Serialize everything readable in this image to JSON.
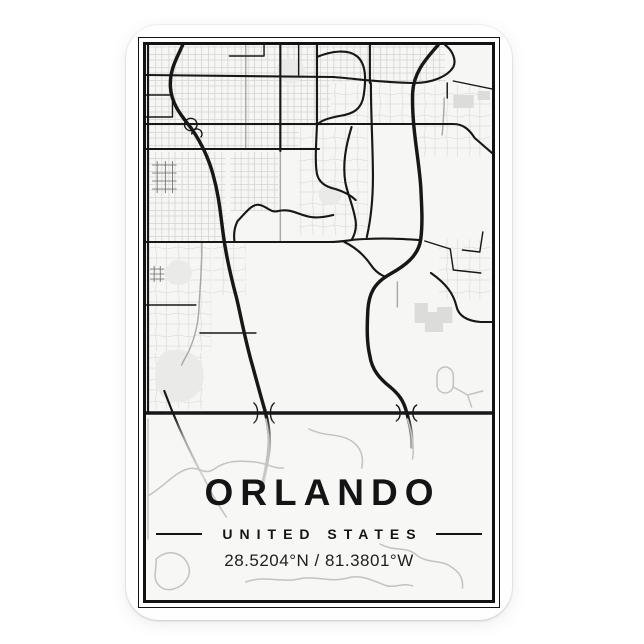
{
  "poster": {
    "title": "ORLANDO",
    "subtitle": "UNITED STATES",
    "coordinates": "28.5204°N / 81.3801°W"
  },
  "colors": {
    "page_bg": "#ffffff",
    "card_bg": "#fefefe",
    "frame": "#121212",
    "map_bg": "#f6f6f4",
    "road_major": "#171717",
    "road_medium": "#a8a8a8",
    "road_minor": "#d4d4d2",
    "road_minor_light": "#dfdedc",
    "road_faded": "#c3c3c1",
    "block_fill": "#eaeae8",
    "structure_fill": "#dcdcda",
    "text": "#141414"
  },
  "map": {
    "highways": [
      "M 186,46 C 181,58 173,70 174,88 C 175,106 186,118 195,130 C 203,142 211,157 216,176 C 222,198 223,214 226,236 C 229,259 234,280 239,299 C 243,316 248,344 255,368 C 259,383 263,398 267,412 C 270,424 272,436 271,448 C 270,462 267,472 265,484",
      "M 437,46 C 427,58 413,72 412,94 C 411,128 418,158 420,188 C 421,209 422,224 420,240 C 418,257 404,267 390,275 C 374,284 369,295 368,311 C 367,330 367,344 370,357 C 372,371 380,380 390,388 C 398,395 403,401 406,413 C 409,424 412,436 411,448",
      "M 150,414 L 490,414"
    ],
    "majors": [
      "M 150,76 L 334,78 C 358,80 388,84 414,84 C 430,84 446,78 452,68 C 455,62 452,52 444,46",
      "M 150,125 L 452,125 C 462,125 468,131 473,139 L 490,154",
      "M 150,150 L 320,150",
      "M 150,243 L 330,243 C 346,243 352,240 366,240 C 386,239 402,240 419,241",
      "M 282,46 L 282,152",
      "M 318,46 L 318,126",
      "M 318,58 C 332,52 348,50 357,57 C 367,65 366,82 364,96 C 362,110 354,115 340,117 C 329,119 321,122 318,126",
      "M 370,46 L 370,84",
      "M 371,84 C 371,118 373,148 373,178 C 373,200 371,220 367,238",
      "M 152,46 L 152,414",
      "M 168,392 C 176,414 188,442 200,466 C 203,472 206,477 208,481",
      "M 318,126 C 317,148 316,164 318,175 C 320,184 327,188 336,190 C 346,193 352,197 356,201",
      "M 352,128 C 346,148 343,166 346,184 C 349,198 354,208 356,222 C 357,230 355,236 352,241",
      "M 334,216 C 326,218 318,219 312,218 C 300,216 292,209 280,212 C 272,214 270,208 262,206 C 254,204 248,214 240,222 C 237,228 236,236 237,243",
      "M 430,274 C 444,284 452,294 455,307 C 457,317 466,322 479,323 L 490,323",
      "M 345,243 C 357,249 365,257 371,266 C 375,272 380,276 386,278"
    ],
    "majors_thin": [
      "M 452,82 L 490,90",
      "M 150,96 L 176,96 M 176,96 L 176,118 M 150,118 L 176,118",
      "M 232,57 L 266,57 M 266,57 L 266,46 M 300,46 L 300,76",
      "M 150,306 L 199,306",
      "M 203,334 L 258,334",
      "M 424,242 L 449,250 M 449,250 L 452,271 M 452,271 L 479,274 M 461,251 L 478,253 M 478,253 L 481,233",
      "M 446,84 L 446,99",
      "M 188,124 a 6,6 0 1 0 12,3 a 6,6 0 1 0 -12,-3 M 195,135 a 5,5 0 1 1 9,3",
      "M 256,404 C 261,408 261,420 256,424 M 276,404 C 271,408 271,420 276,424",
      "M 396,406 C 401,409 401,419 396,422 M 416,406 C 411,409 411,419 416,422"
    ],
    "mediums": [
      "M 248,46 L 248,150",
      "M 205,243 C 205,268 203,290 202,310 C 201,328 197,340 193,350 C 190,357 187,361 185,366",
      "M 282,152 L 282,242",
      "M 443,99 C 443,114 442,124 441,136",
      "M 397,283 L 397,308"
    ],
    "minors_dark": [
      "M 156,166 H 180 M 156,174 H 180 M 156,182 H 180 M 156,190 H 180 M 161,162 V 194 M 169,162 V 194 M 176,162 V 194",
      "M 154,270 H 168 M 154,275 H 168 M 154,280 H 168 M 158,267 V 283 M 164,267 V 283"
    ],
    "blobs": [
      "M 170,352 C 186,348 202,354 206,370 C 209,386 201,400 186,403 C 170,406 159,394 159,379 C 159,366 162,356 170,352 Z",
      "M 288,60 C 298,58 306,64 306,72 C 306,80 298,85 290,84 C 282,83 278,76 279,68 C 280,63 283,61 288,60 Z",
      "M 328,186 C 336,184 342,189 342,196 C 342,203 336,207 329,206 C 322,205 319,199 320,193 C 321,189 324,187 328,186 Z",
      "M 176,262 C 186,259 194,264 195,272 C 196,281 189,287 180,286 C 171,285 167,278 169,270 Z"
    ],
    "structures": [
      "M 414,304 h 13 v 9 h 9 v -5 h 15 v 16 h -9 v 9 h -18 v -9 h -10 Z",
      "M 452,96 h 20 v 13 h -20 Z",
      "M 476,92 h 12 v 9 h -12 Z"
    ],
    "zones_dense": [
      "M 153,47 H 331 V 127 H 300 V 151 H 153 Z",
      "M 153,153 H 228 V 242 H 153 Z",
      "M 233,153 H 280 V 212 H 233 Z",
      "M 332,47 H 444 V 83 H 332 Z"
    ],
    "zones_suburb": [
      "M 153,244 H 214 V 352 H 153 Z",
      "M 332,84 H 412 V 126 H 332 Z",
      "M 300,128 H 368 V 236 H 300 Z",
      "M 414,86 H 488 V 158 H 414 Z",
      "M 153,354 H 206 V 410 H 153 Z",
      "M 438,240 H 488 V 300 H 438 Z",
      "M 216,244 H 248 V 296 H 216 Z"
    ],
    "faded": [
      "M 152,420 L 152,540",
      "M 268,420 C 271,436 272,450 269,464 C 267,477 262,488 260,500",
      "M 407,420 C 411,434 414,446 412,460",
      "M 208,481 C 214,494 221,506 229,518",
      "M 152,497 C 168,487 179,473 191,470 C 203,467 207,477 217,470 C 231,460 245,462 257,463 C 268,464 276,470 285,469",
      "M 160,560 C 172,549 186,554 191,565 C 196,576 188,587 177,590 C 166,593 158,585 159,574 C 160,568 160,564 160,560",
      "M 248,583 C 266,576 284,584 300,580 C 316,576 330,584 348,579 C 360,575 372,581 384,586 C 394,590 402,583 412,587",
      "M 380,545 C 394,553 406,547 416,556 C 426,565 440,560 450,568 C 458,573 462,580 461,589",
      "M 310,430 C 326,438 340,434 352,442 C 362,449 364,459 362,469",
      "M 444,368 a 8,9 0 0 1 8,9 v 9 a 8,8 0 0 1 -16,0 v -9 a 8,9 0 0 1 8,-9 Z M 452,388 L 466,396 M 466,396 L 470,408 M 466,396 L 481,392"
    ]
  }
}
